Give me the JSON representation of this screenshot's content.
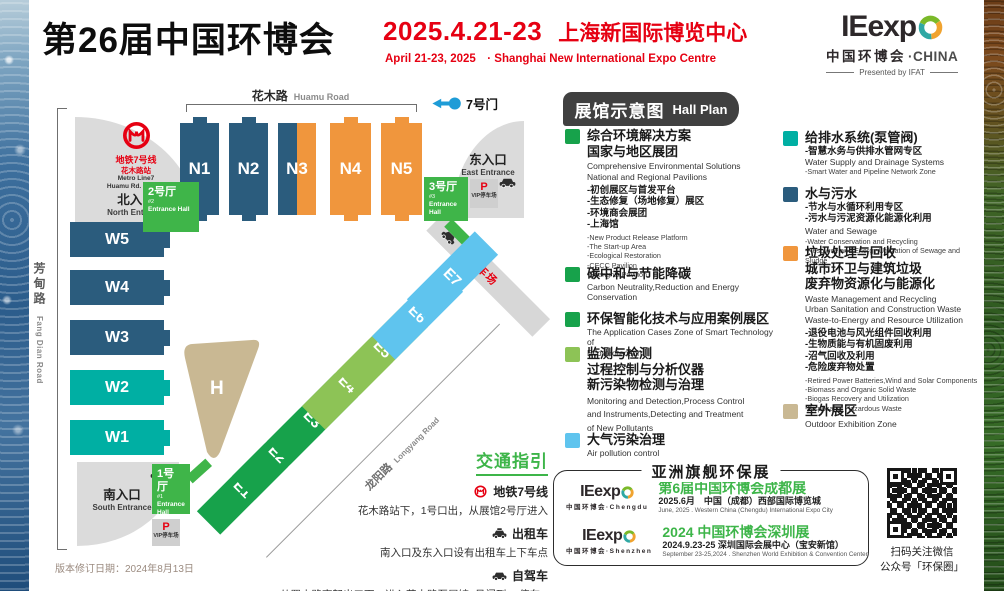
{
  "header": {
    "title": "第26届中国环博会",
    "date": "2025.4.21-23",
    "venue_cn": "上海新国际博览中心",
    "subtitle_en": "April 21-23, 2025　· Shanghai New International Expo Centre"
  },
  "logo": {
    "brand": "IEexp",
    "cn": "中国环博会",
    "dot_china": "·CHINA",
    "presented": "Presented by IFAT",
    "ring_green": "#7ab929",
    "ring_orange": "#f0a32f",
    "ring_teal": "#2fa8a4"
  },
  "colors": {
    "red": "#e60012",
    "navy": "#2b5c7d",
    "orange": "#f0963d",
    "teal": "#00afa3",
    "green": "#17a24b",
    "green_light": "#8dc356",
    "sky": "#5fc4ee",
    "tan": "#c9b893",
    "entrance_green": "#3fb549",
    "gate_blue": "#1e9cd7"
  },
  "map": {
    "roads": {
      "huamu": "花木路",
      "huamu_en": "Huamu Road",
      "fangdian": "芳甸路",
      "fangdian_en": "Fang Dian Road",
      "longyang": "龙阳路",
      "longyang_en": "Longyang Road"
    },
    "gate7_label": "7号门",
    "metro": {
      "line_cn": "地铁7号线",
      "station_cn": "花木路站",
      "line_en": "Metro Line7",
      "station_en": "Huamu Rd. Station"
    },
    "entrances": {
      "north_cn": "北入口",
      "north_en": "North Entrance",
      "east_cn": "东入口",
      "east_en": "East Entrance",
      "south_cn": "南入口",
      "south_en": "South Entrance"
    },
    "entrance_halls": {
      "h1_cn": "1号厅",
      "h1_no": "#1",
      "h2_cn": "2号厅",
      "h2_no": "#2",
      "h3_cn": "3号厅",
      "h3_no": "#3",
      "en": "Entrance Hall"
    },
    "parking": {
      "p1": "P1停车场",
      "p": "P",
      "vip": "VIP停车场"
    },
    "halls": {
      "n1": "N1",
      "n2": "N2",
      "n3": "N3",
      "n4": "N4",
      "n5": "N5",
      "w1": "W1",
      "w2": "W2",
      "w3": "W3",
      "w4": "W4",
      "w5": "W5",
      "h": "H",
      "e1": "E1",
      "e2": "E2",
      "e3": "E3",
      "e4": "E4",
      "e5": "E5",
      "e6": "E6",
      "e7": "E7"
    }
  },
  "legend": {
    "header_cn": "展馆示意图",
    "header_en": "Hall Plan",
    "items": {
      "comprehensive": {
        "color": "#17a24b",
        "t1": "综合环境解决方案",
        "t2": "国家与地区展团",
        "e1": "Comprehensive Environmental Solutions",
        "e2": "National and Regional Pavilions",
        "s1": "-初创展区与首发平台",
        "s2": "-生态修复（场地修复）展区",
        "s3": "-环境商会展团",
        "s4": "-上海馆",
        "se1": "-New Product Release Platform",
        "se2": "-The Start-up Area",
        "se3": "-Ecological Restoration",
        "se4": "-CECC Pavilion",
        "se5": "-Shanghai Pavilion"
      },
      "carbon": {
        "color": "#17a24b",
        "t1": "碳中和与节能降碳",
        "e1": "Carbon Neutrality,Reduction and Energy Conservation"
      },
      "smart": {
        "color": "#17a24b",
        "t1": "环保智能化技术与应用案例展区",
        "e1": "The Application Cases Zone of Smart Technology of",
        "e2": "Eco-protection"
      },
      "monitoring": {
        "color": "#8dc356",
        "t1": "监测与检测",
        "t2": "过程控制与分析仪器",
        "t3": "新污染物检测与治理",
        "e1": "Monitoring and Detection,Process Control",
        "e2": "and Instruments,Detecting and Treatment",
        "e3": "of New Pollutants"
      },
      "air": {
        "color": "#5fc4ee",
        "t1": "大气污染治理",
        "e1": "Air pollution control"
      },
      "water_supply": {
        "color": "#00afa3",
        "t1": "给排水系统(泵管阀)",
        "s1": "-智慧水务与供排水管网专区",
        "e1": "Water Supply and Drainage Systems",
        "se1": "-Smart Water and Pipeline Network Zone"
      },
      "sewage": {
        "color": "#2b5c7d",
        "t1": "水与污水",
        "s1": "-节水与水循环利用专区",
        "s2": "-污水与污泥资源化能源化利用",
        "e1": "Water and Sewage",
        "se1": "-Water Conservation and Recycling",
        "se2": "-Resource and Energy Utilization of Sewage and Sludge"
      },
      "waste": {
        "color": "#f0963d",
        "t1": "垃圾处理与回收",
        "t2": "城市环卫与建筑垃圾",
        "t3": "废弃物资源化与能源化",
        "e1": "Waste Management and Recycling",
        "e2": "Urban Sanitation and Construction Waste",
        "e3": "Waste-to-Energy and Resource Utilization",
        "s1": "-退役电池与风光组件回收利用",
        "s2": "-生物质能与有机固废利用",
        "s3": "-沼气回收及利用",
        "s4": "-危险废弃物处置",
        "se1": "-Retired Power Batteries,Wind and Solar Components",
        "se2": "-Biomass and Organic Solid Waste",
        "se3": "-Biogas Recovery and Utilization",
        "se4": "-Disposal of Hazardous Waste"
      },
      "outdoor": {
        "color": "#c9b893",
        "t1": "室外展区",
        "e1": "Outdoor Exhibition Zone"
      }
    }
  },
  "traffic": {
    "title": "交通指引",
    "metro_label": "地铁7号线",
    "metro_desc": "花木路站下，1号口出，从展馆2号厅进入",
    "taxi_label": "出租车",
    "taxi_desc": "南入口及东入口设有出租车上下车点",
    "car_label": "自驾车",
    "car_desc": "从罗山路高架出口下，进入花木路至展馆7号门到P1停车场"
  },
  "flagship": {
    "title": "亚洲旗舰环保展",
    "chengdu": {
      "name": "第6届中国环博会成都展",
      "info": "2025.6月　中国（成都）西部国际博览城",
      "en": "June, 2025 . Western China (Chengdu) International Expo City",
      "logo_sub": "中国环博会·Chengdu"
    },
    "shenzhen": {
      "name": "2024 中国环博会深圳展",
      "info": "2024.9.23-25 深圳国际会展中心（宝安新馆）",
      "en": "September 23-25,2024 . Shenzhen World Exhibition & Convention Center",
      "logo_sub": "中国环博会·Shenzhen"
    }
  },
  "qr": {
    "line1": "扫码关注微信",
    "line2": "公众号「环保圈」"
  },
  "footer": {
    "version_note": "版本修订日期：2024年8月13日"
  }
}
